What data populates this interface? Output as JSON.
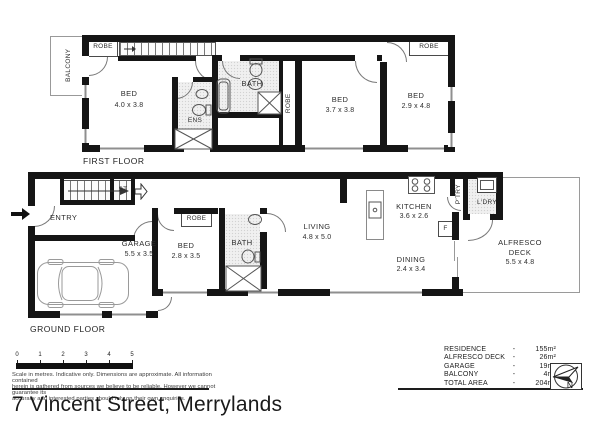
{
  "title": "7 Vincent Street, Merrylands",
  "first_floor": {
    "label": "FIRST FLOOR",
    "balcony": "BALCONY",
    "robe_left": "ROBE",
    "bed1_name": "BED",
    "bed1_dims": "4.0 x 3.8",
    "ens": "ENS",
    "bath": "BATH",
    "robe_mid": "ROBE",
    "bed2_name": "BED",
    "bed2_dims": "3.7 x 3.8",
    "bed3_name": "BED",
    "bed3_dims": "2.9 x 4.8",
    "robe_right": "ROBE"
  },
  "ground_floor": {
    "label": "GROUND FLOOR",
    "entry": "ENTRY",
    "storage": "ST",
    "garage_name": "GARAGE",
    "garage_dims": "5.5 x 3.5",
    "bed_name": "BED",
    "bed_dims": "2.8 x 3.5",
    "robe": "ROBE",
    "bath": "BATH",
    "living_name": "LIVING",
    "living_dims": "4.8 x 5.0",
    "kitchen_name": "KITCHEN",
    "kitchen_dims": "3.6 x 2.6",
    "pantry": "P'TRY",
    "laundry": "L'DRY",
    "fridge": "F",
    "dining_name": "DINING",
    "dining_dims": "2.4 x 3.4",
    "alfresco_line1": "ALFRESCO",
    "alfresco_line2": "DECK",
    "alfresco_dims": "5.5 x 4.8"
  },
  "scale_bar": {
    "ticks": [
      "0",
      "1",
      "2",
      "3",
      "4",
      "5"
    ]
  },
  "disclaimer": {
    "line1": "Scale in metres. Indicative only. Dimensions are approximate. All information contained",
    "line2": "herein is gathered from sources we believe to be reliable. However we cannot guarantee its",
    "line3": "accuracy and interested parties should rely on their own enquiries."
  },
  "legend": {
    "rows": [
      {
        "label": "RESIDENCE",
        "sep": "-",
        "value": "155m²"
      },
      {
        "label": "ALFRESCO DECK",
        "sep": "-",
        "value": "26m²"
      },
      {
        "label": "GARAGE",
        "sep": "-",
        "value": "19m²"
      },
      {
        "label": "BALCONY",
        "sep": "-",
        "value": "4m²"
      },
      {
        "label": "TOTAL AREA",
        "sep": "-",
        "value": "204m²"
      }
    ]
  },
  "compass": {
    "north": "N"
  },
  "colors": {
    "wall": "#151515",
    "text": "#2d2d2d",
    "thin_line": "#9a9a9a"
  }
}
